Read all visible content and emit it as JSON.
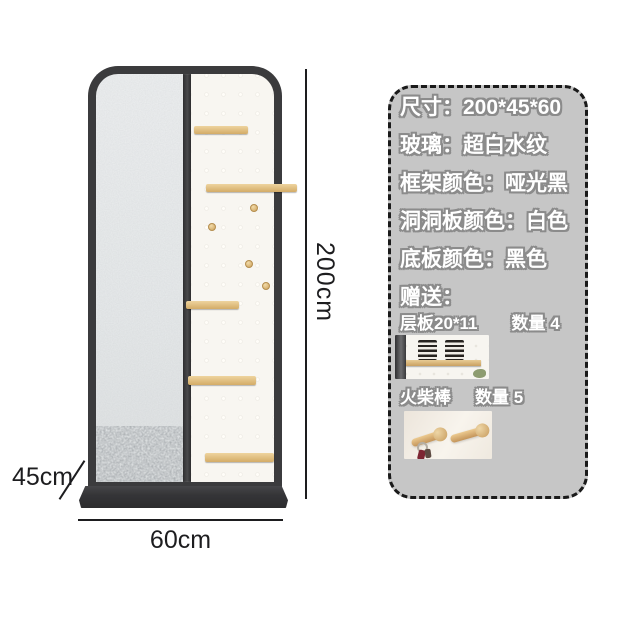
{
  "dimensions": {
    "height_label": "200cm",
    "depth_label": "45cm",
    "width_label": "60cm"
  },
  "spec_panel": {
    "size": "尺寸：200*45*60",
    "glass": "玻璃：超白水纹",
    "frame_color": "框架颜色：哑光黑",
    "pegboard_color": "洞洞板颜色：白色",
    "base_color": "底板颜色：黑色",
    "gift_heading": "赠送：",
    "gift1_name": "层板20*11",
    "gift1_qty": "数量 4",
    "gift2_name": "火柴棒",
    "gift2_qty": "数量 5"
  },
  "colors": {
    "panel_bg": "#c6c6c6",
    "panel_border": "#1a1a1a",
    "spec_text_fill": "#ffffff",
    "spec_text_outline": "#8b8b8b",
    "frame": "#3b3b3d",
    "base": "#37373a",
    "wood": "#dcba7d",
    "pegboard": "#f8f6f1",
    "glass": "#e9ebec",
    "annotation_text": "#1d1d1f"
  }
}
